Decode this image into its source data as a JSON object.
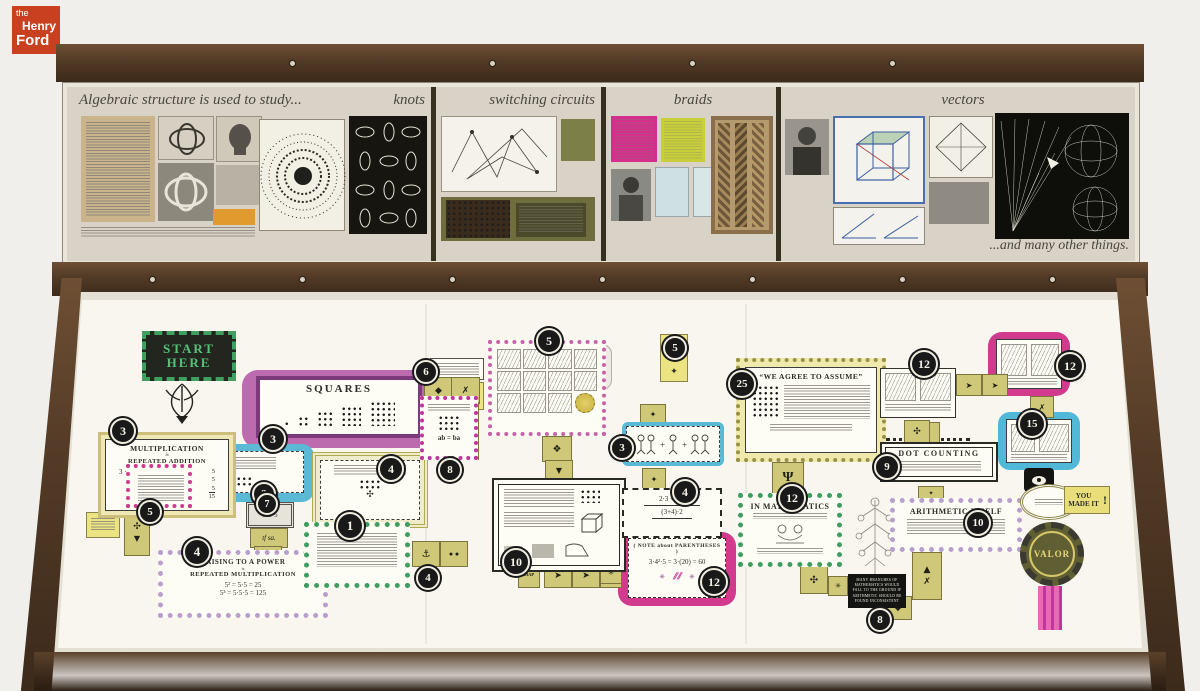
{
  "logo": {
    "word1": "the",
    "word2": "Henry",
    "word3": "Ford"
  },
  "upper": {
    "intro": "Algebraic structure is used to study...",
    "sections": [
      {
        "label": "knots"
      },
      {
        "label": "switching circuits"
      },
      {
        "label": "braids"
      },
      {
        "label": "vectors"
      }
    ],
    "outro": "...and many other things."
  },
  "flow": {
    "start": "START HERE",
    "think": "THINK",
    "tfsa": "tf sa.",
    "map": "MAP",
    "youmadeit": "YOU MADE IT",
    "bang": "!",
    "valor": "VALOR",
    "note": "MANY BRANCHES OF MATHEMATICS WOULD FALL TO THE GROUND IF ARITHMETIC SHOULD BE FOUND INCONSISTENT",
    "mult": {
      "num": "3",
      "t1": "MULTIPLICATION",
      "mid": "is",
      "t2": "REPEATED ADDITION",
      "e1": "3 · 5",
      "r1": "5",
      "r2": "5",
      "r3": "5",
      "sum": "15"
    },
    "pink5": {
      "num": "5"
    },
    "squares": {
      "num": "3",
      "title": "SQUARES"
    },
    "olive4": {
      "num": "4"
    },
    "cyan3": {
      "num": "3"
    },
    "gray7": {
      "num": "7",
      "eq": "5·5·5"
    },
    "green1": {
      "num": "1"
    },
    "power": {
      "num": "4",
      "t1": "RAISING TO A POWER",
      "mid": "is",
      "t2": "REPEATED MULTIPLICATION",
      "e1": "5² = 5·5 = 25",
      "e2": "5³ = 5·5·5 = 125"
    },
    "mid4": {
      "num": "4"
    },
    "comics5": {
      "num": "5"
    },
    "tag6": {
      "num": "6"
    },
    "comm8": {
      "num": "8",
      "eq": "ab = ba"
    },
    "people3": {
      "num": "3"
    },
    "assoc4": {
      "num": "4",
      "e1": "2·3 + 4·2",
      "e2": "(3+4)·2"
    },
    "box10": {
      "num": "10"
    },
    "parens": {
      "num": "12",
      "title": "( NOTE about PARENTHESES )",
      "eq": "3·4²·5 = 3·(20) = 60"
    },
    "assume": {
      "num": "25",
      "title": "“WE AGREE TO ASSUME”"
    },
    "inmath": {
      "num": "12",
      "title": "IN MATHEMATICS"
    },
    "dotcount": {
      "num": "9",
      "title": "DOT COUNTING"
    },
    "arith": {
      "num": "10",
      "title": "ARITHMETIC ITSELF"
    },
    "sketch12": {
      "num": "12"
    },
    "pink12": {
      "num": "12"
    },
    "cyan15": {
      "num": "15"
    },
    "end8": {
      "num": "8"
    },
    "tag5top": {
      "num": "5"
    }
  },
  "icons": {
    "bird": "➤",
    "trident": "Ψ",
    "cross": "✗",
    "diamond": "◆",
    "up": "▲",
    "down": "▼",
    "star": "✳",
    "clover": "✣",
    "flower": "✦",
    "burst": "❖",
    "anchor": "⚓"
  },
  "colors": {
    "logo_red": "#c8401f",
    "green": "#3f9e5f",
    "pink": "#d23a8e",
    "cyan": "#52b8d8",
    "purple": "#7c3a7c",
    "lavender": "#b9a0cc",
    "olive": "#cfc878",
    "wood": "#4f3a28"
  }
}
